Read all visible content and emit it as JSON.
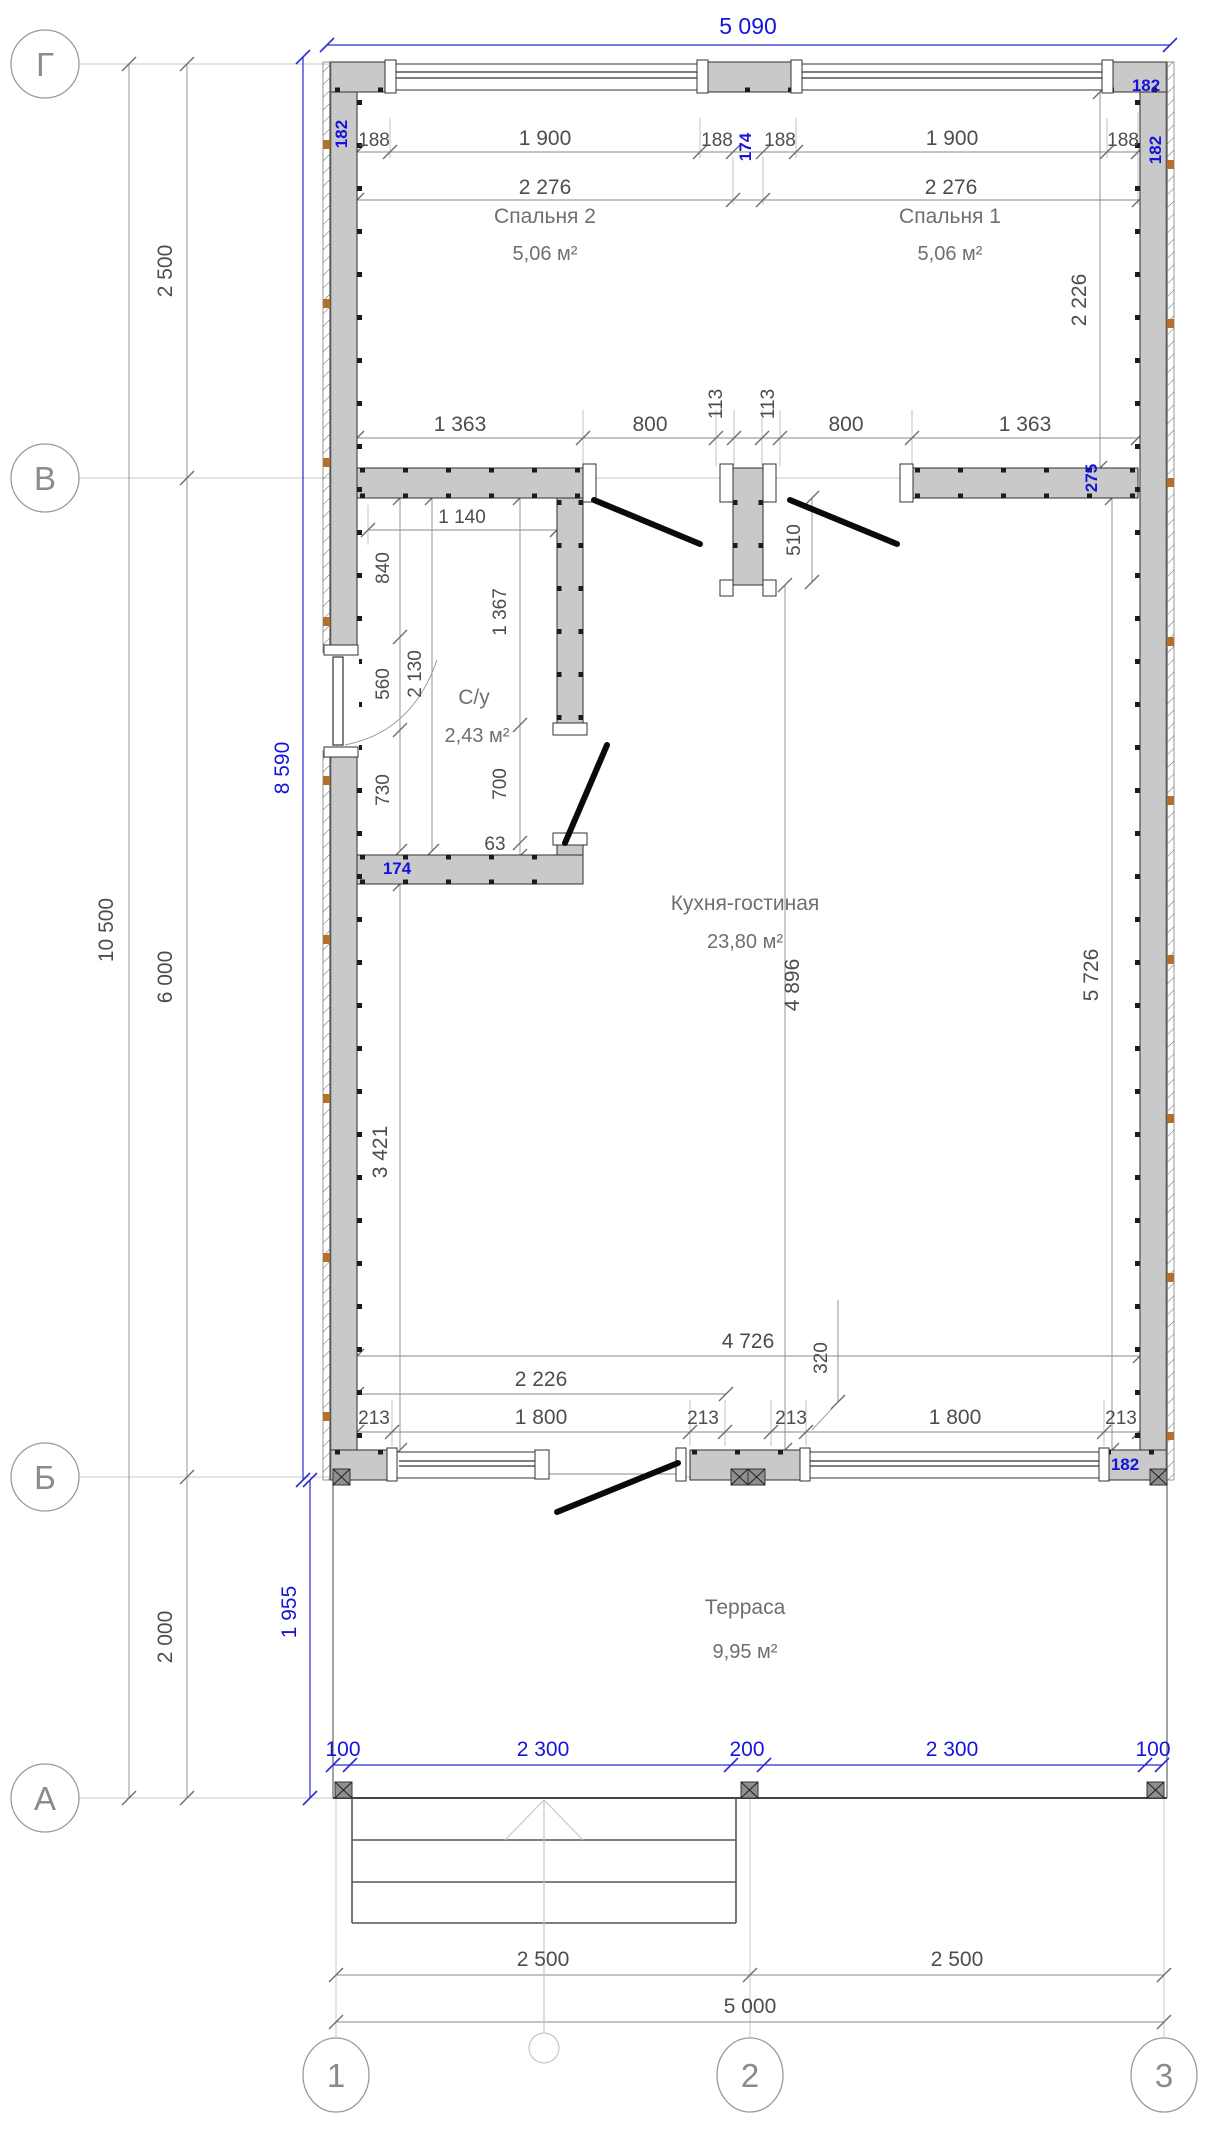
{
  "axes": {
    "g": "Г",
    "v": "В",
    "b": "Б",
    "a": "А",
    "n1": "1",
    "n2": "2",
    "n3": "3"
  },
  "rooms": {
    "bedroom2": {
      "name": "Спальня 2",
      "area": "5,06 м²"
    },
    "bedroom1": {
      "name": "Спальня 1",
      "area": "5,06 м²"
    },
    "bathroom": {
      "name": "С/у",
      "area": "2,43 м²"
    },
    "kitchen": {
      "name": "Кухня-гостиная",
      "area": "23,80 м²"
    },
    "terrace": {
      "name": "Терраса",
      "area": "9,95 м²"
    }
  },
  "dims": {
    "overall_top": "5 090",
    "total_height": "10 500",
    "g_v": "2 500",
    "v_b": "6 000",
    "b_a": "2 000",
    "margin188": "188",
    "window1900": "1 900",
    "room_w2276": "2 276",
    "room_h2226": "2 226",
    "part1363": "1 363",
    "door800": "800",
    "jamb113": "113",
    "stub510": "510",
    "bath1140": "1 140",
    "bath840": "840",
    "bath560": "560",
    "bath730": "730",
    "bath2130": "2 130",
    "bath1367": "1 367",
    "bath700": "700",
    "bath63": "63",
    "kitchen4896": "4 896",
    "kitchen5726": "5 726",
    "kitchen3421": "3 421",
    "kitchen4726": "4 726",
    "kitchen320": "320",
    "bottom2226": "2 226",
    "bottom213": "213",
    "bottom1800": "1 800",
    "axis2500": "2 500",
    "axis5000": "5 000"
  },
  "blue": {
    "inner_height": "8 590",
    "terrace_depth": "1 955",
    "wall182": "182",
    "wall174": "174",
    "wall275": "275",
    "t100": "100",
    "t2300": "2 300",
    "t200": "200"
  }
}
